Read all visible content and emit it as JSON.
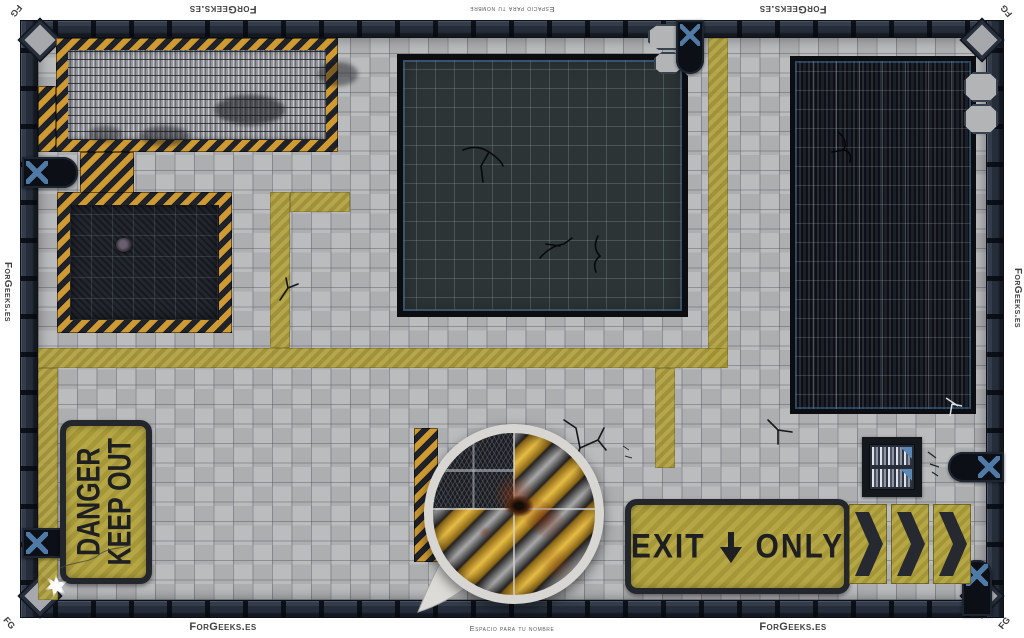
{
  "branding": {
    "brand": "ForGeeks.es",
    "name_placeholder": "Espacio para tu nombre",
    "corner_logo": "FG"
  },
  "signs": {
    "danger": {
      "line1": "DANGER",
      "line2": "KEEP OUT"
    },
    "exit": {
      "word_left": "EXIT",
      "word_right": "ONLY",
      "arrow_icon": "down-arrow"
    },
    "chevrons": {
      "count": 3,
      "direction": "right"
    }
  },
  "colors": {
    "floor": "#b6b7b9",
    "grid_line": "#85888d",
    "wall": "#252d3b",
    "hazard_orange": "#cf9a31",
    "hazard_dark": "#20222a",
    "paint_yellow": "#b1a039",
    "sign_yellow": "#b2a23c",
    "sign_border": "#23262b",
    "sign_text": "#1d1f23",
    "accent_blue": "#4f7aa6",
    "blood_rust": "#8a3c1a"
  },
  "features": {
    "platforms": [
      "metal-grate-platform",
      "tread-plate-platform",
      "concrete-pit",
      "server-grate-pit"
    ],
    "callout": "magnified-blood-stain-tile",
    "terminal": "control-panel",
    "door_count": 5,
    "hatches": "octagonal-floor-plates"
  }
}
